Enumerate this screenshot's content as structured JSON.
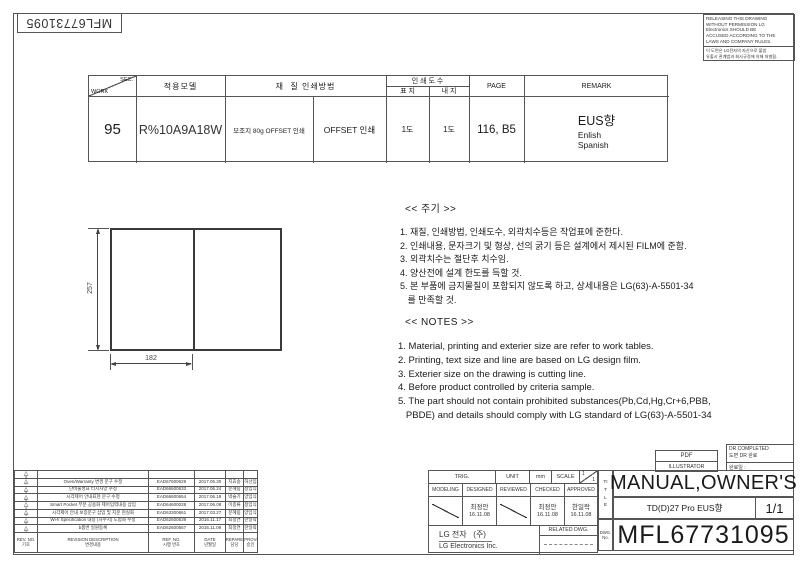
{
  "colors": {
    "ink": "#1a1a1a",
    "line": "#555555"
  },
  "corner_part_no": "MFL67731095",
  "warning_box": {
    "en": [
      "RELEASING THIS DRAWING",
      "WITHOUT PERMISSION LG",
      "Electronics SHOULD BE",
      "ACCUSED ACCORDING TO THE",
      "LAWS AND COMPANY RULES."
    ],
    "ko": [
      "이 도면은 LG전자의 자산으로 불법",
      "유출시 관계법과 회사규정에 의해 처벌됨."
    ]
  },
  "work_table": {
    "sec": "SEC.",
    "work": "WORK",
    "col_model": "적용모델",
    "col_material_method": "재  질 인쇄방법",
    "col_print_count": "인 쇄 도 수",
    "col_cover": "표 지",
    "col_inner": "내 지",
    "col_page": "PAGE",
    "col_remark": "REMARK",
    "work_no": "95",
    "model": "R%10A9A18W",
    "material": "모조지 80g OFFSET 인쇄",
    "method": "OFFSET 인쇄",
    "cover_count": "1도",
    "inner_count": "1도",
    "page": "116, B5",
    "remark_region": "EUS향",
    "remark_lang1": "Enlish",
    "remark_lang2": "Spanish"
  },
  "drawing": {
    "dim_height": "257",
    "dim_width": "182"
  },
  "notes_ko": {
    "title": "<< 주기 >>",
    "items": [
      "1. 재질, 인쇄방법, 인쇄도수, 외곽치수등은 작업표에 준한다.",
      "2. 인쇄내용, 문자크기 및 형상, 선의 굵기 등은 설계에서 제시된 FILM에 준함.",
      "3. 외곽치수는 절단후 치수임.",
      "4. 양산전에 설계 한도를 득할 것.",
      "5. 본 부품에 금지물질이 포함되지 않도록 하고, 상세내용은 LG(63)-A-5501-34\n   를 만족할 것."
    ]
  },
  "notes_en": {
    "title": "<< NOTES >>",
    "items": [
      "1. Material, printing and exterier size are refer to work tables.",
      "2. Printing, text size and line are based on LG design film.",
      "3. Exterier size on the drawing is cutting line.",
      "4. Before product controlled by criteria sample.",
      "5. The part should not contain prohibited substances(Pb,Cd,Hg,Cr+6,PBB,\n   PBDE) and details should comply with LG standard of LG(63)-A-5501-34"
    ]
  },
  "revision_table": {
    "header": {
      "rev_no": "REV. NO.",
      "rev_no_ko": "기호",
      "description": "REVISION DESCRIPTION",
      "description_ko": "변경내용",
      "ref_no": "REF. NO.",
      "ref_no_ko": "시행 번호",
      "date": "DATE",
      "date_ko": "년월일",
      "prepared": "PREPARED",
      "prepared_ko": "담당",
      "approved": "APPROVED",
      "approved_ko": "승인"
    },
    "rows": [
      {
        "no": "8",
        "desc": "",
        "ref": "",
        "date": "",
        "prepared": "",
        "approved": ""
      },
      {
        "no": "7",
        "desc": "Oven/Warranty 변경 문구 수정",
        "ref": "EAD67600629",
        "date": "2017.05.30",
        "prepared": "지효송",
        "approved": "허선임"
      },
      {
        "no": "6",
        "desc": "단비물성표 터치사양 수정",
        "ref": "EAD66600633",
        "date": "2017.06.24",
        "prepared": "문혜림",
        "approved": "정임식"
      },
      {
        "no": "5",
        "desc": "시각제어 안내표현 문구 수정",
        "ref": "EAD66600654",
        "date": "2017.06.19",
        "prepared": "박슬기",
        "approved": "양임식"
      },
      {
        "no": "4",
        "desc": "Smart Pocket 부분 공용화 제어입력내용 삽입",
        "ref": "EAD64600028",
        "date": "2017.06.08",
        "prepared": "이종류",
        "approved": "정임식"
      },
      {
        "no": "3",
        "desc": "시각제어 안내 보증문구 삽입 및 지문 현실화",
        "ref": "EAD63300661",
        "date": "2017.03.27",
        "prepared": "문혜림",
        "approved": "양임식"
      },
      {
        "no": "2",
        "desc": "Wi-fi Specification 내용 (자수치) 도합화 수정",
        "ref": "EAD62600639",
        "date": "2016.11.17",
        "prepared": "최정연",
        "approved": "한일락"
      },
      {
        "no": "1",
        "desc": "b품번 일원등록",
        "ref": "EAD62600567",
        "date": "2016.11.08",
        "prepared": "최정연",
        "approved": "한일락"
      }
    ]
  },
  "signoff": {
    "trig": "TRIG.",
    "unit_label": "UNIT",
    "unit_value": "mm",
    "scale_label": "SCALE",
    "scale_num": "1",
    "scale_den": "1",
    "col_modeling": "MODELING",
    "col_designed": "DESIGNED",
    "col_reviewed": "REVIEWED",
    "col_checked": "CHECKED",
    "col_approved": "APPROVED",
    "designed_name": "최정안",
    "designed_date": "16.11.08",
    "checked_name": "최정안",
    "checked_date": "16.11.08",
    "approved_name": "한일락",
    "approved_date": "16.11.08",
    "company_ko": "LG 전자   (주)",
    "company_en": "LG Electronics Inc.",
    "related_dwg": "RELATED DWG."
  },
  "output_info": {
    "pdf": "PDF",
    "illustrator": "ILLUSTRATOR",
    "dr_completed": "DR COMPLETED",
    "dr_completed_ko": "도면 DR 완료",
    "completion_date_label": "완료일 :"
  },
  "title_block": {
    "title_label_vertical": "TITLE",
    "dwg_no_label": "DWG. No.",
    "title": "MANUAL,OWNER'S",
    "model_spec": "TD(D)27 Pro EUS향",
    "sheet": "1/1",
    "drawing_number": "MFL67731095"
  }
}
